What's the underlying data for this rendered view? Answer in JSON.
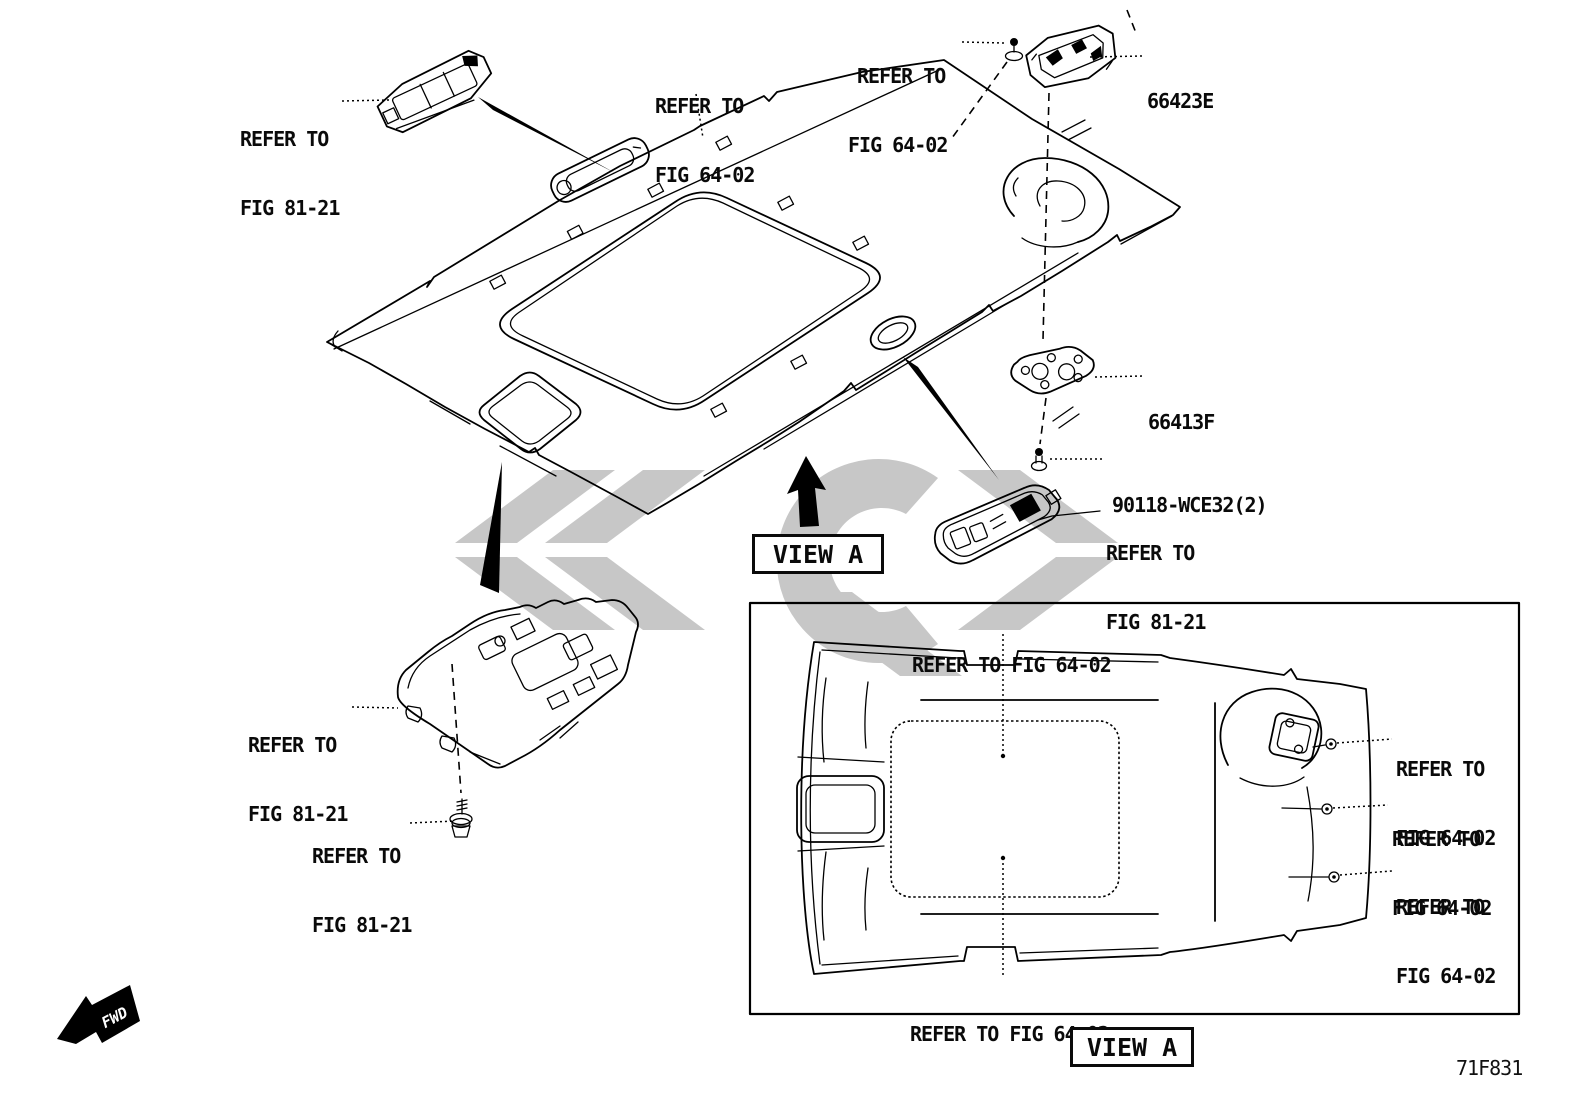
{
  "figure": {
    "code": "71F831"
  },
  "view": {
    "label": "VIEW A"
  },
  "fwd": {
    "label": "FWD"
  },
  "parts": {
    "lamp_assy_rear": "66423E",
    "bracket": "66413F",
    "screw": "90118-WCE32(2)"
  },
  "refs": {
    "refer_to": "REFER TO",
    "fig_81_21": "FIG 81-21",
    "fig_64_02": "FIG 64-02",
    "refer_to_fig_64_02": "REFER TO FIG 64-02"
  },
  "colors": {
    "line": "#000000",
    "background": "#ffffff",
    "watermark": "#c7c7c7"
  }
}
